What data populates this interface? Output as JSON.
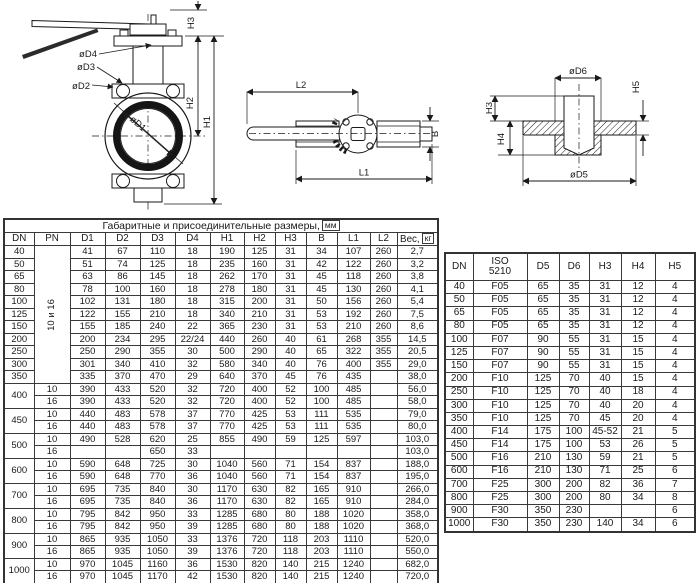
{
  "drawings": {
    "front_view": {
      "labels": {
        "d4": "øD4",
        "d3": "øD3",
        "d2": "øD2",
        "d1": "øD1",
        "h1": "H1",
        "h2": "H2",
        "h3": "H3"
      }
    },
    "top_view": {
      "labels": {
        "l1": "L1",
        "l2": "L2",
        "b": "B"
      }
    },
    "flange_view": {
      "labels": {
        "d5": "øD5",
        "d6": "øD6",
        "h3": "H3",
        "h4": "H4",
        "h5": "H5"
      }
    }
  },
  "main_table": {
    "title": "Габаритные и присоединительные размеры,",
    "title_unit": "мм",
    "headers": [
      "DN",
      "PN",
      "D1",
      "D2",
      "D3",
      "D4",
      "H1",
      "H2",
      "H3",
      "B",
      "L1",
      "L2"
    ],
    "weight_label": "Вес,",
    "weight_unit": "кг",
    "pn_group_label": "10 и 16",
    "pn_labels": [
      "10",
      "16"
    ],
    "single_rows": [
      {
        "dn": "40",
        "cells": [
          "41",
          "67",
          "110",
          "18",
          "190",
          "125",
          "31",
          "34",
          "107",
          "260",
          "2,7"
        ]
      },
      {
        "dn": "50",
        "cells": [
          "51",
          "74",
          "125",
          "18",
          "235",
          "160",
          "31",
          "42",
          "122",
          "260",
          "3,2"
        ]
      },
      {
        "dn": "65",
        "cells": [
          "63",
          "86",
          "145",
          "18",
          "262",
          "170",
          "31",
          "45",
          "118",
          "260",
          "3,8"
        ]
      },
      {
        "dn": "80",
        "cells": [
          "78",
          "100",
          "160",
          "18",
          "278",
          "180",
          "31",
          "45",
          "130",
          "260",
          "4,1"
        ]
      },
      {
        "dn": "100",
        "cells": [
          "102",
          "131",
          "180",
          "18",
          "315",
          "200",
          "31",
          "50",
          "156",
          "260",
          "5,4"
        ]
      },
      {
        "dn": "125",
        "cells": [
          "122",
          "155",
          "210",
          "18",
          "340",
          "210",
          "31",
          "53",
          "192",
          "260",
          "7,5"
        ]
      },
      {
        "dn": "150",
        "cells": [
          "155",
          "185",
          "240",
          "22",
          "365",
          "230",
          "31",
          "53",
          "210",
          "260",
          "8,6"
        ]
      },
      {
        "dn": "200",
        "cells": [
          "200",
          "234",
          "295",
          "22/24",
          "440",
          "260",
          "40",
          "61",
          "268",
          "355",
          "14,5"
        ]
      },
      {
        "dn": "250",
        "cells": [
          "250",
          "290",
          "355",
          "30",
          "500",
          "290",
          "40",
          "65",
          "322",
          "355",
          "20,5"
        ]
      },
      {
        "dn": "300",
        "cells": [
          "301",
          "340",
          "410",
          "32",
          "580",
          "340",
          "40",
          "76",
          "400",
          "355",
          "29,0"
        ]
      },
      {
        "dn": "350",
        "cells": [
          "335",
          "370",
          "470",
          "29",
          "640",
          "370",
          "45",
          "76",
          "435",
          "",
          "38,0"
        ]
      }
    ],
    "double_rows": [
      {
        "dn": "400",
        "pn10": [
          "390",
          "433",
          "520",
          "32",
          "720",
          "400",
          "52",
          "100",
          "485",
          "",
          "56,0"
        ],
        "pn16": [
          "390",
          "433",
          "520",
          "32",
          "720",
          "400",
          "52",
          "100",
          "485",
          "",
          "58,0"
        ]
      },
      {
        "dn": "450",
        "pn10": [
          "440",
          "483",
          "578",
          "37",
          "770",
          "425",
          "53",
          "111",
          "535",
          "",
          "79,0"
        ],
        "pn16": [
          "440",
          "483",
          "578",
          "37",
          "770",
          "425",
          "53",
          "111",
          "535",
          "",
          "80,0"
        ]
      },
      {
        "dn": "500",
        "pn10": [
          "490",
          "528",
          "620",
          "25",
          "855",
          "490",
          "59",
          "125",
          "597",
          "",
          "103,0"
        ],
        "pn16": [
          "",
          "",
          "650",
          "33",
          "",
          "",
          "",
          "",
          "",
          "",
          "103,0"
        ]
      },
      {
        "dn": "600",
        "pn10": [
          "590",
          "648",
          "725",
          "30",
          "1040",
          "560",
          "71",
          "154",
          "837",
          "",
          "188,0"
        ],
        "pn16": [
          "590",
          "648",
          "770",
          "36",
          "1040",
          "560",
          "71",
          "154",
          "837",
          "",
          "195,0"
        ]
      },
      {
        "dn": "700",
        "pn10": [
          "695",
          "735",
          "840",
          "30",
          "1170",
          "630",
          "82",
          "165",
          "910",
          "",
          "266,0"
        ],
        "pn16": [
          "695",
          "735",
          "840",
          "36",
          "1170",
          "630",
          "82",
          "165",
          "910",
          "",
          "284,0"
        ]
      },
      {
        "dn": "800",
        "pn10": [
          "795",
          "842",
          "950",
          "33",
          "1285",
          "680",
          "80",
          "188",
          "1020",
          "",
          "358,0"
        ],
        "pn16": [
          "795",
          "842",
          "950",
          "39",
          "1285",
          "680",
          "80",
          "188",
          "1020",
          "",
          "368,0"
        ]
      },
      {
        "dn": "900",
        "pn10": [
          "865",
          "935",
          "1050",
          "33",
          "1376",
          "720",
          "118",
          "203",
          "1110",
          "",
          "520,0"
        ],
        "pn16": [
          "865",
          "935",
          "1050",
          "39",
          "1376",
          "720",
          "118",
          "203",
          "1110",
          "",
          "550,0"
        ]
      },
      {
        "dn": "1000",
        "pn10": [
          "970",
          "1045",
          "1160",
          "36",
          "1530",
          "820",
          "140",
          "215",
          "1240",
          "",
          "682,0"
        ],
        "pn16": [
          "970",
          "1045",
          "1170",
          "42",
          "1530",
          "820",
          "140",
          "215",
          "1240",
          "",
          "720,0"
        ]
      }
    ]
  },
  "iso_table": {
    "header_dn": "DN",
    "header_iso_line1": "ISO",
    "header_iso_line2": "5210",
    "headers_rest": [
      "D5",
      "D6",
      "H3",
      "H4",
      "H5"
    ],
    "rows": [
      {
        "dn": "40",
        "cells": [
          "F05",
          "65",
          "35",
          "31",
          "12",
          "4"
        ]
      },
      {
        "dn": "50",
        "cells": [
          "F05",
          "65",
          "35",
          "31",
          "12",
          "4"
        ]
      },
      {
        "dn": "65",
        "cells": [
          "F05",
          "65",
          "35",
          "31",
          "12",
          "4"
        ]
      },
      {
        "dn": "80",
        "cells": [
          "F05",
          "65",
          "35",
          "31",
          "12",
          "4"
        ]
      },
      {
        "dn": "100",
        "cells": [
          "F07",
          "90",
          "55",
          "31",
          "15",
          "4"
        ]
      },
      {
        "dn": "125",
        "cells": [
          "F07",
          "90",
          "55",
          "31",
          "15",
          "4"
        ]
      },
      {
        "dn": "150",
        "cells": [
          "F07",
          "90",
          "55",
          "31",
          "15",
          "4"
        ]
      },
      {
        "dn": "200",
        "cells": [
          "F10",
          "125",
          "70",
          "40",
          "15",
          "4"
        ]
      },
      {
        "dn": "250",
        "cells": [
          "F10",
          "125",
          "70",
          "40",
          "18",
          "4"
        ]
      },
      {
        "dn": "300",
        "cells": [
          "F10",
          "125",
          "70",
          "40",
          "20",
          "4"
        ]
      },
      {
        "dn": "350",
        "cells": [
          "F10",
          "125",
          "70",
          "45",
          "20",
          "4"
        ]
      },
      {
        "dn": "400",
        "cells": [
          "F14",
          "175",
          "100",
          "45-52",
          "21",
          "5"
        ]
      },
      {
        "dn": "450",
        "cells": [
          "F14",
          "175",
          "100",
          "53",
          "26",
          "5"
        ]
      },
      {
        "dn": "500",
        "cells": [
          "F16",
          "210",
          "130",
          "59",
          "21",
          "5"
        ]
      },
      {
        "dn": "600",
        "cells": [
          "F16",
          "210",
          "130",
          "71",
          "25",
          "6"
        ]
      },
      {
        "dn": "700",
        "cells": [
          "F25",
          "300",
          "200",
          "82",
          "36",
          "7"
        ]
      },
      {
        "dn": "800",
        "cells": [
          "F25",
          "300",
          "200",
          "80",
          "34",
          "8"
        ]
      },
      {
        "dn": "900",
        "cells": [
          "F30",
          "350",
          "230",
          "",
          "",
          "6"
        ]
      },
      {
        "dn": "1000",
        "cells": [
          "F30",
          "350",
          "230",
          "140",
          "34",
          "6"
        ]
      }
    ]
  }
}
